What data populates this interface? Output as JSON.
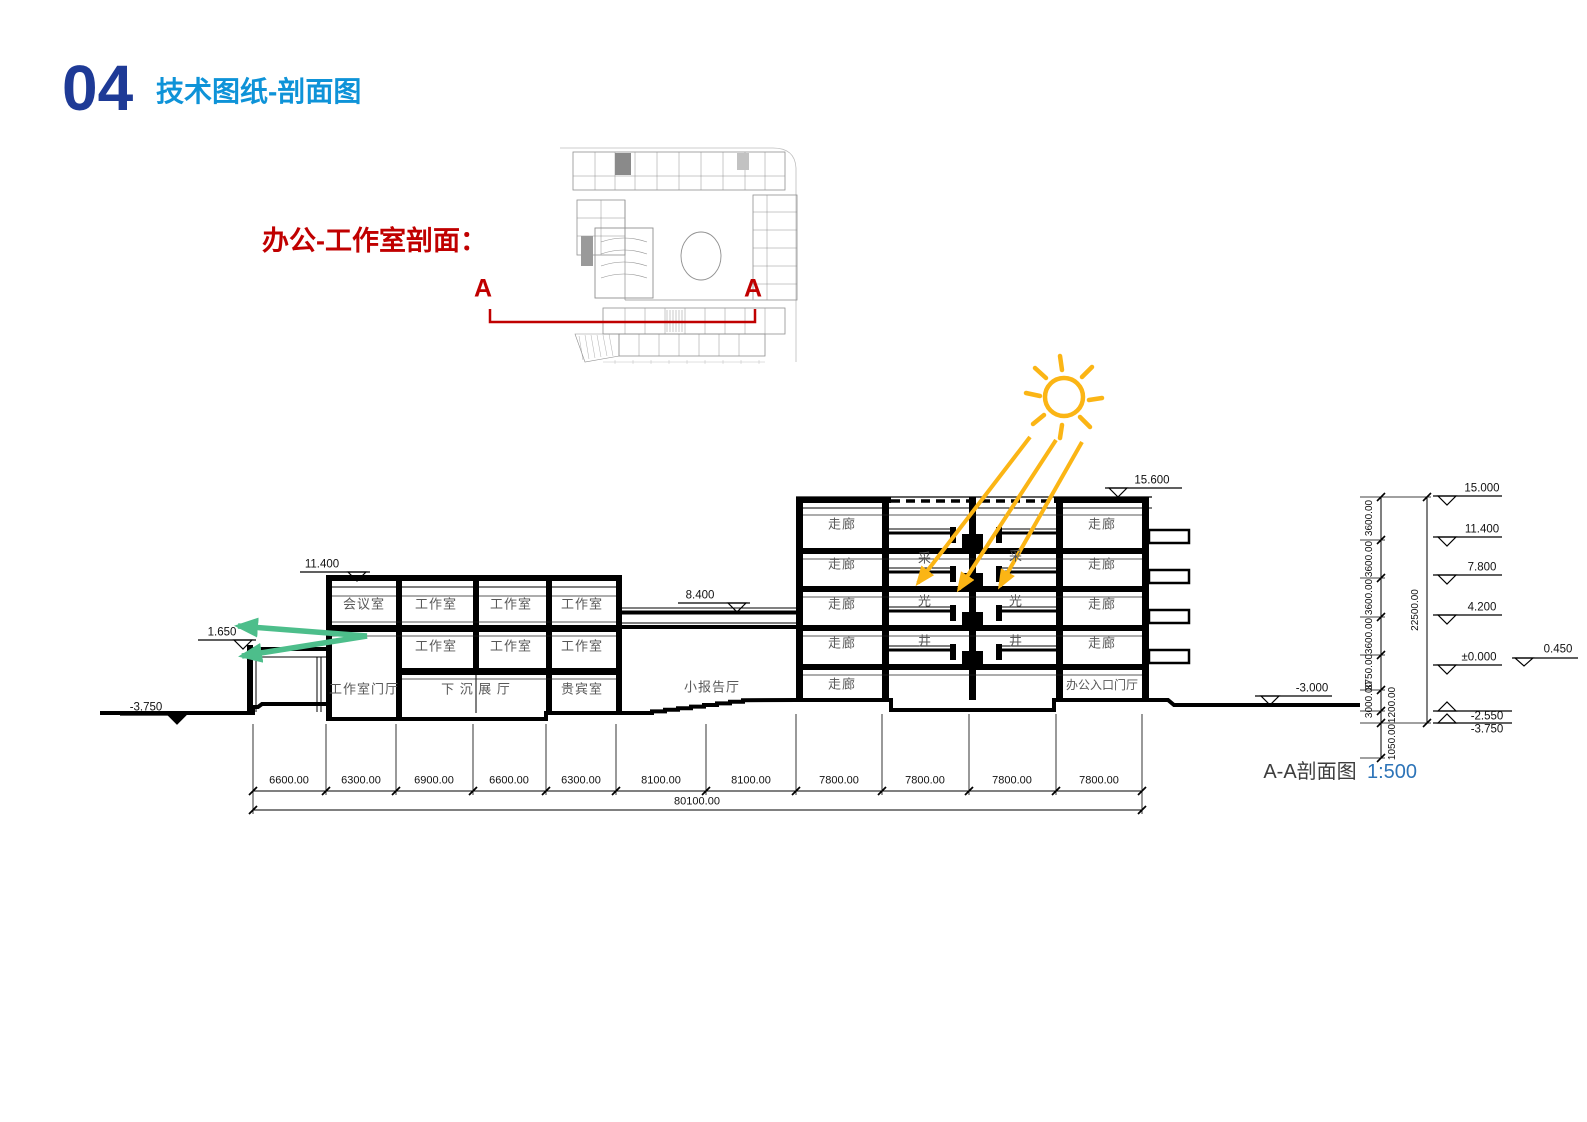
{
  "header": {
    "number": "04",
    "title": "技术图纸-剖面图"
  },
  "plan": {
    "caption": "办公-工作室剖面：",
    "marker_a": "A"
  },
  "rooms": {
    "meeting": "会议室",
    "studio": "工作室",
    "studio_lobby": "工作室门厅",
    "sunken_hall": "下 沉 展 厅",
    "vip": "贵宾室",
    "lecture_hall": "小报告厅",
    "corridor": "走廊",
    "office_entrance": "办公入口门厅",
    "skylight_cai": "采",
    "skylight_guang": "光",
    "skylight_jing": "井"
  },
  "levels": {
    "left_roof": "11.400",
    "canopy": "1.650",
    "ground_left": "-3.750",
    "bridge": "8.400",
    "right_roof": "15.600",
    "ground_right": "-3.000"
  },
  "level_stack": {
    "l15": "15.000",
    "l114": "11.400",
    "l78": "7.800",
    "l42": "4.200",
    "l00": "±0.000",
    "l045": "0.450",
    "lm255": "-2.550",
    "lm375": "-3.750"
  },
  "vdims": {
    "segments": [
      "3600.00",
      "3600.00",
      "3600.00",
      "3600.00",
      "3750.00",
      "3000.00"
    ],
    "below1": "1200.00",
    "below2": "1050.00",
    "total": "22500.00"
  },
  "hdims": {
    "segments": [
      "6600.00",
      "6300.00",
      "6900.00",
      "6600.00",
      "6300.00",
      "8100.00",
      "8100.00",
      "7800.00",
      "7800.00",
      "7800.00",
      "7800.00"
    ],
    "total": "80100.00"
  },
  "caption": {
    "title": "A-A剖面图",
    "scale": "1:500"
  },
  "colors": {
    "accent_navy": "#1e3a96",
    "accent_azure": "#0e93d8",
    "accent_red": "#c00000",
    "sun_yellow": "#fbb515",
    "arrow_green": "#4dbe8b",
    "line_black": "#000000"
  }
}
